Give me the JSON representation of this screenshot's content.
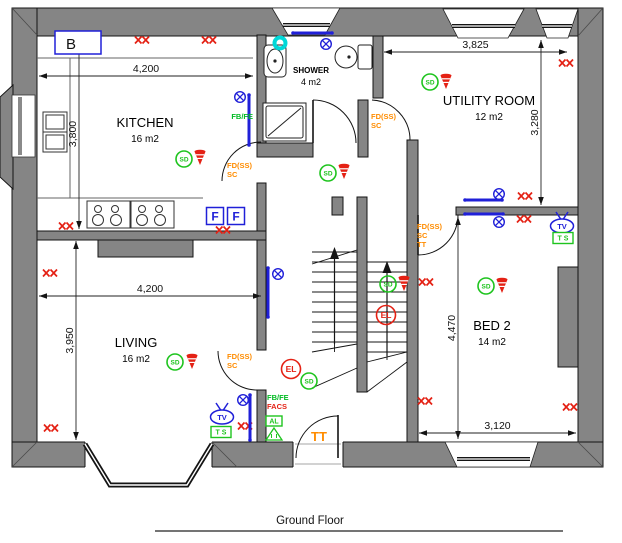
{
  "floor": {
    "title": "Ground Floor"
  },
  "colors": {
    "wall": "#858585",
    "socket_red": "#e42114",
    "detector_green": "#1ec41e",
    "electric_blue": "#2020d8",
    "fan_cyan": "#00d8d8",
    "annotation_orange": "#ff8c00",
    "annotation_green": "#00bb22",
    "annotation_red": "#e42114",
    "line_black": "#141414"
  },
  "symbol_text": {
    "smoke_detector": "SD",
    "emergency_light": "EL",
    "tv_point": "TV",
    "tv_socket": "T S",
    "fridge_box": "F",
    "boiler_box": "B",
    "alarm_box": "AL"
  },
  "rooms": [
    {
      "name": "KITCHEN",
      "area": "16 m2",
      "x": 145,
      "y": 127,
      "small": false
    },
    {
      "name": "SHOWER",
      "area": "4 m2",
      "x": 311,
      "y": 73,
      "small": true
    },
    {
      "name": "UTILITY ROOM",
      "area": "12 m2",
      "x": 489,
      "y": 105,
      "small": false
    },
    {
      "name": "LIVING",
      "area": "16 m2",
      "x": 136,
      "y": 347,
      "small": false
    },
    {
      "name": "BED 2",
      "area": "14 m2",
      "x": 492,
      "y": 330,
      "small": false
    }
  ],
  "dimensions": [
    {
      "text": "4,200",
      "orient": "h",
      "x1": 39,
      "x2": 253,
      "y": 76
    },
    {
      "text": "3,800",
      "orient": "v",
      "y1": 39,
      "y2": 229,
      "x": 79
    },
    {
      "text": "3,825",
      "orient": "h",
      "x1": 384,
      "x2": 567,
      "y": 52
    },
    {
      "text": "3,280",
      "orient": "v",
      "y1": 40,
      "y2": 205,
      "x": 541
    },
    {
      "text": "4,200",
      "orient": "h",
      "x1": 39,
      "x2": 261,
      "y": 296
    },
    {
      "text": "3,950",
      "orient": "v",
      "y1": 241,
      "y2": 440,
      "x": 76
    },
    {
      "text": "4,470",
      "orient": "v",
      "y1": 217,
      "y2": 439,
      "x": 458
    },
    {
      "text": "3,120",
      "orient": "h",
      "x1": 419,
      "x2": 576,
      "y": 433
    }
  ],
  "symbols": {
    "sockets": [
      [
        80,
        40
      ],
      [
        142,
        40
      ],
      [
        209,
        40
      ],
      [
        66,
        226
      ],
      [
        223,
        230
      ],
      [
        50,
        273
      ],
      [
        51,
        428
      ],
      [
        245,
        426
      ],
      [
        566,
        63
      ],
      [
        525,
        196
      ],
      [
        524,
        219
      ],
      [
        426,
        282
      ],
      [
        425,
        401
      ],
      [
        570,
        407
      ]
    ],
    "smoke_detectors": [
      [
        184,
        159
      ],
      [
        328,
        173
      ],
      [
        430,
        82
      ],
      [
        388,
        284
      ],
      [
        309,
        381
      ],
      [
        175,
        362
      ],
      [
        486,
        286
      ]
    ],
    "sounders": [
      [
        200,
        158
      ],
      [
        344,
        172
      ],
      [
        446,
        82
      ],
      [
        404,
        284
      ],
      [
        192,
        362
      ],
      [
        502,
        286
      ]
    ],
    "lights": [
      [
        240,
        97
      ],
      [
        326,
        44
      ],
      [
        278,
        274
      ],
      [
        243,
        400
      ],
      [
        499,
        194
      ],
      [
        499,
        222
      ]
    ],
    "emergency_lights": [
      [
        291,
        369
      ],
      [
        386,
        315
      ]
    ],
    "radiators": [
      [
        249,
        95,
        249,
        145
      ],
      [
        293,
        33,
        332,
        33
      ],
      [
        268,
        268,
        268,
        317
      ],
      [
        250,
        395,
        250,
        440
      ],
      [
        465,
        200,
        502,
        200
      ],
      [
        465,
        214,
        503,
        214
      ]
    ],
    "fans": [
      [
        280,
        43
      ]
    ],
    "tv_points": [
      [
        222,
        417
      ],
      [
        562,
        226
      ]
    ],
    "tv_sockets": [
      [
        221,
        432
      ],
      [
        563,
        238
      ]
    ],
    "fridge_boxes": [
      [
        215,
        216
      ],
      [
        236,
        216
      ]
    ],
    "boiler_box": {
      "x": 55,
      "y": 31,
      "w": 46,
      "h": 23
    },
    "alarm_box": {
      "x": 274,
      "y": 421
    }
  },
  "annotations": [
    {
      "lines": [
        "FD(SS)",
        "SC"
      ],
      "x": 227,
      "y": 168,
      "color": "orange",
      "size": 7.5,
      "anchor": "start"
    },
    {
      "lines": [
        "FD(SS)",
        "SC"
      ],
      "x": 371,
      "y": 119,
      "color": "orange",
      "size": 7.5,
      "anchor": "start"
    },
    {
      "lines": [
        "FD(SS)",
        "SC"
      ],
      "x": 227,
      "y": 359,
      "color": "orange",
      "size": 7.5,
      "anchor": "start"
    },
    {
      "lines": [
        "FD(SS)",
        "SC",
        "TT"
      ],
      "x": 417,
      "y": 229,
      "color": "orange",
      "size": 7.5,
      "anchor": "start"
    },
    {
      "lines": [
        "TT"
      ],
      "x": 311,
      "y": 441,
      "color": "orange",
      "size": 13,
      "anchor": "start"
    },
    {
      "lines": [
        "FB/FE"
      ],
      "x": 253,
      "y": 119,
      "color": "green",
      "size": 7.5,
      "anchor": "end"
    },
    {
      "lines": [
        "FB/FE"
      ],
      "x": 267,
      "y": 400,
      "color": "green",
      "size": 7.5,
      "anchor": "start"
    },
    {
      "lines": [
        "FACS"
      ],
      "x": 267,
      "y": 409,
      "color": "red",
      "size": 7.5,
      "anchor": "start"
    }
  ]
}
